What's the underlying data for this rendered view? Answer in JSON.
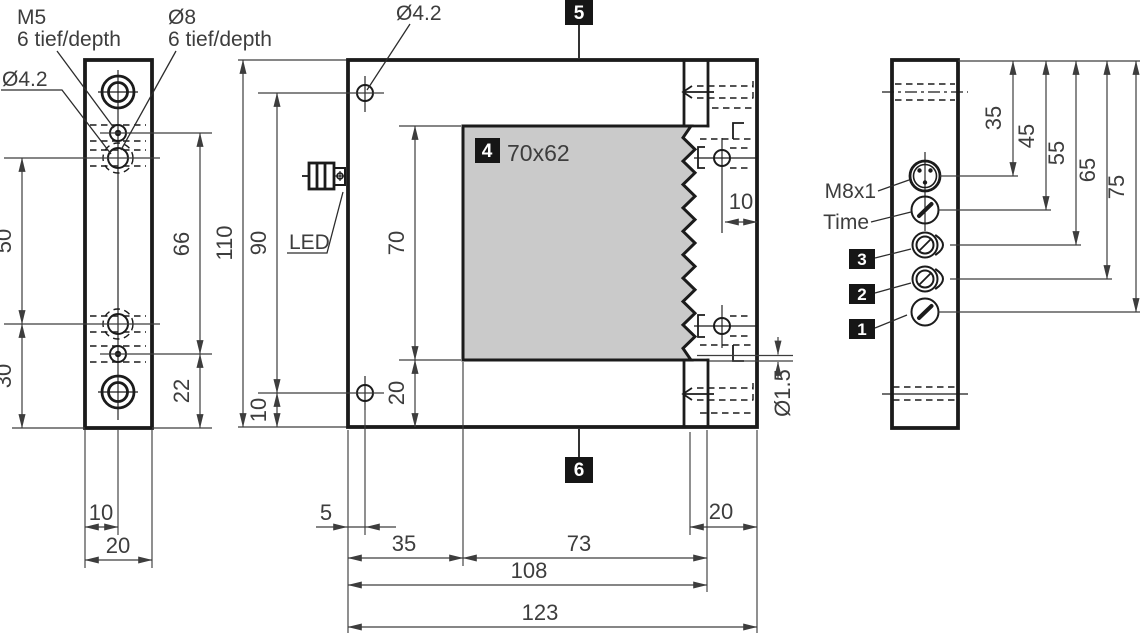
{
  "left_view": {
    "callouts": {
      "m5": "M5",
      "m5_depth": "6 tief/depth",
      "o8": "Ø8",
      "o8_depth": "6 tief/depth",
      "o42": "Ø4.2"
    },
    "dims": {
      "d50": "50",
      "d30": "30",
      "d66": "66",
      "d22": "22",
      "d10": "10",
      "d20": "20"
    }
  },
  "front_view": {
    "callouts": {
      "o42": "Ø4.2",
      "led": "LED",
      "o15": "Ø1.5"
    },
    "badges": {
      "b4": "4",
      "b5": "5",
      "b6": "6"
    },
    "window_label": "70x62",
    "dims": {
      "d110": "110",
      "d90": "90",
      "d70": "70",
      "d20_side": "20",
      "d10_side": "10",
      "d10_edge": "10",
      "d5": "5",
      "d35": "35",
      "d73": "73",
      "d108": "108",
      "d123": "123",
      "d20_bottom": "20"
    }
  },
  "right_view": {
    "labels": {
      "m8x1": "M8x1",
      "time": "Time"
    },
    "badges": {
      "b3": "3",
      "b2": "2",
      "b1": "1"
    },
    "dims": {
      "d35": "35",
      "d45": "45",
      "d55": "55",
      "d65": "65",
      "d75": "75"
    }
  },
  "colors": {
    "outline": "#1b1b1b",
    "dim_line": "#3d3d3d",
    "window_fill": "#cacaca",
    "badge_bg": "#161616",
    "badge_text": "#ffffff",
    "background": "#ffffff"
  }
}
